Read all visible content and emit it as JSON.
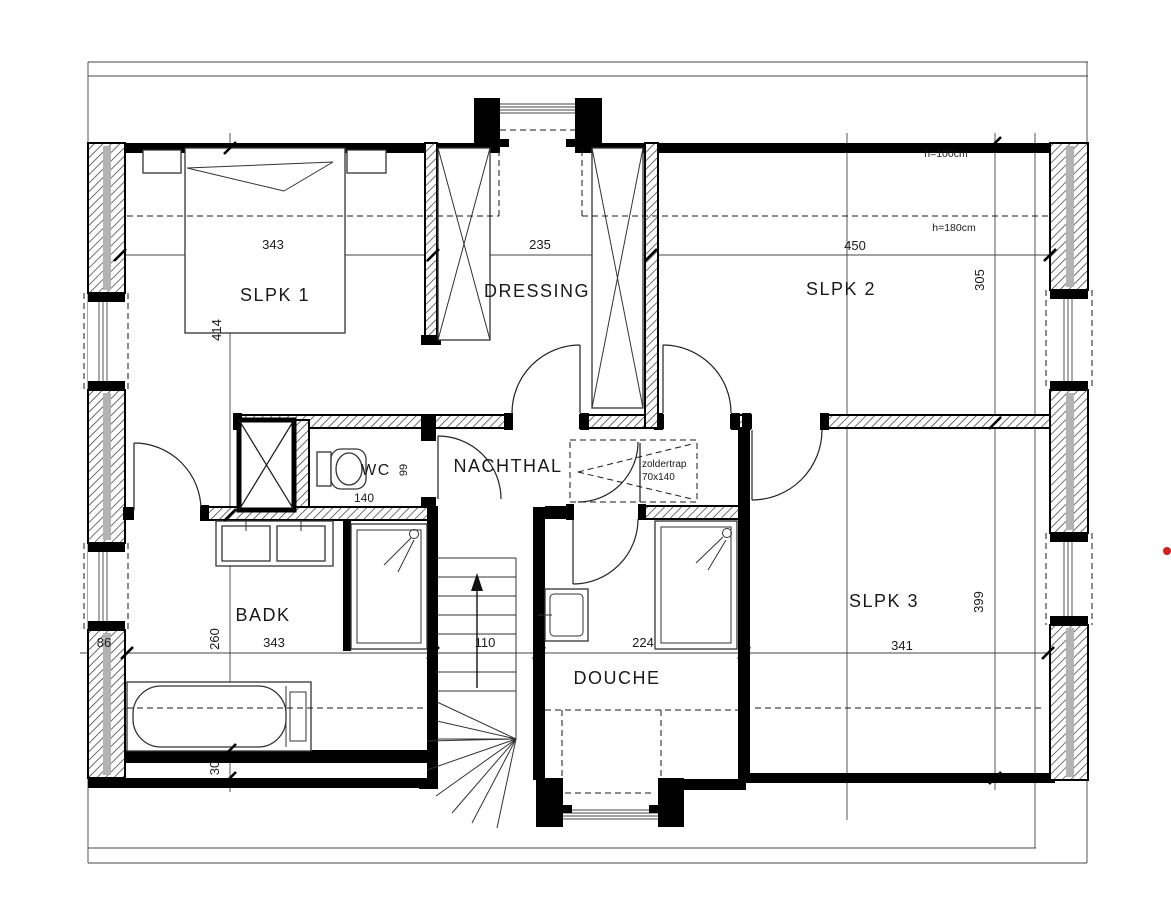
{
  "plan": {
    "rooms": {
      "slpk1": {
        "label": "SLPK 1",
        "width": "343",
        "height": "414"
      },
      "dressing": {
        "label": "DRESSING",
        "width": "235"
      },
      "slpk2": {
        "label": "SLPK 2",
        "width": "450",
        "height": "305",
        "kneewall_note": "h=100cm",
        "headroom_note": "h=180cm"
      },
      "wc": {
        "label": "WC",
        "width": "140",
        "depth": "99"
      },
      "nachthal": {
        "label": "NACHTHAL"
      },
      "badk": {
        "label": "BADK",
        "width": "343",
        "depth": "260",
        "kneewall_offset": "30",
        "window_width": "86"
      },
      "stairs": {
        "width": "110"
      },
      "douche": {
        "label": "DOUCHE",
        "width": "224"
      },
      "slpk3": {
        "label": "SLPK 3",
        "width": "341",
        "height": "399"
      }
    },
    "attic_hatch": {
      "label": "zoldertrap",
      "size": "70x140"
    },
    "colors": {
      "line": "#1a1a1a",
      "wall": "#000000",
      "insulation": "#b3b3b3",
      "marker": "#cc2222",
      "background": "#ffffff"
    }
  }
}
